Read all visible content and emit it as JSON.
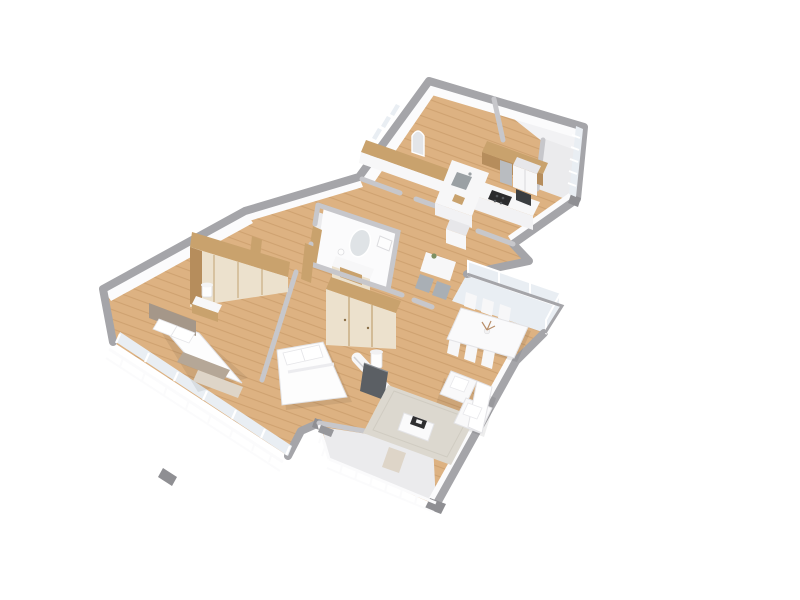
{
  "scene": {
    "type": "3d-floor-plan-render",
    "view": "isometric-top-down",
    "background": "#ffffff",
    "rooms": [
      {
        "name": "entry-hall",
        "furniture": [
          "built-in-closet",
          "arched-mirror",
          "window-slits"
        ]
      },
      {
        "name": "kitchen",
        "furniture": [
          "tall-wood-cabinets",
          "island-with-sink",
          "cooktop-counter",
          "range-hood",
          "oven-microwave",
          "fridge-column"
        ]
      },
      {
        "name": "bathroom",
        "furniture": [
          "oval-mirror",
          "vanity-with-wood-drawers",
          "vanity-lamp",
          "toilet",
          "wood-door"
        ]
      },
      {
        "name": "hallway",
        "furniture": [
          "breakfast-table",
          "gray-chair",
          "gray-chair",
          "white-cabinet-column",
          "wood-door-frames",
          "potted-plant"
        ]
      },
      {
        "name": "bedroom-1",
        "furniture": [
          "double-bed",
          "taupe-headboard",
          "pillows",
          "foot-runner",
          "foot-bench",
          "nightstand",
          "table-lamp",
          "wood-wardrobe-row",
          "floor-to-ceiling-windows"
        ]
      },
      {
        "name": "bedroom-2",
        "furniture": [
          "double-bed",
          "pillows",
          "sliding-wood-wardrobe",
          "floor-lamp",
          "media-wall"
        ]
      },
      {
        "name": "living-dining-room",
        "furniture": [
          "dining-table",
          "six-white-chairs",
          "flower-centerpiece",
          "corner-sofa",
          "area-rug",
          "coffee-table",
          "black-tray",
          "wall-tv",
          "sideboard"
        ]
      },
      {
        "name": "balconies",
        "furniture": [
          "left-railing",
          "center-balcony-bench",
          "center-railing",
          "glazed-balcony",
          "top-right-railing"
        ]
      }
    ]
  },
  "palette": {
    "background": "#ffffff",
    "wall_cap_outer": "#a5a5a9",
    "wall_cap_inner": "#c7c7cb",
    "wall_face": "#f2f2f4",
    "wall_face_bright": "#fbfbfc",
    "wood_floor": "#ddb282",
    "wood_floor_line": "rgba(164,114,60,0.28)",
    "wood_furniture": "#c9a26d",
    "wood_furniture_dark": "#b68d5c",
    "cream_door": "#ece1cd",
    "white_furniture": "#f7f7f8",
    "white_furniture_shade": "#e7e7ea",
    "rug": "#dcd8cf",
    "taupe": "#a59789",
    "taupe_light": "#b5a797",
    "bench_cream": "#ded5c8",
    "balcony_floor": "#ebebed",
    "glass": "#e9eef3",
    "steel": "#b9bcc0",
    "appliance_dark": "#3a3d40",
    "cooktop": "#2b2b2d",
    "tv": "#5b5f64",
    "gray_chair": "#a9afb5",
    "plant": "#7d8f62",
    "flower": "#b98f6a",
    "tray": "#2f2f31",
    "threshold": "#97979b",
    "corner_cap": "#8f8f93",
    "sink": "#9aa0a4",
    "shadow": "rgba(0,0,0,0.07)"
  }
}
